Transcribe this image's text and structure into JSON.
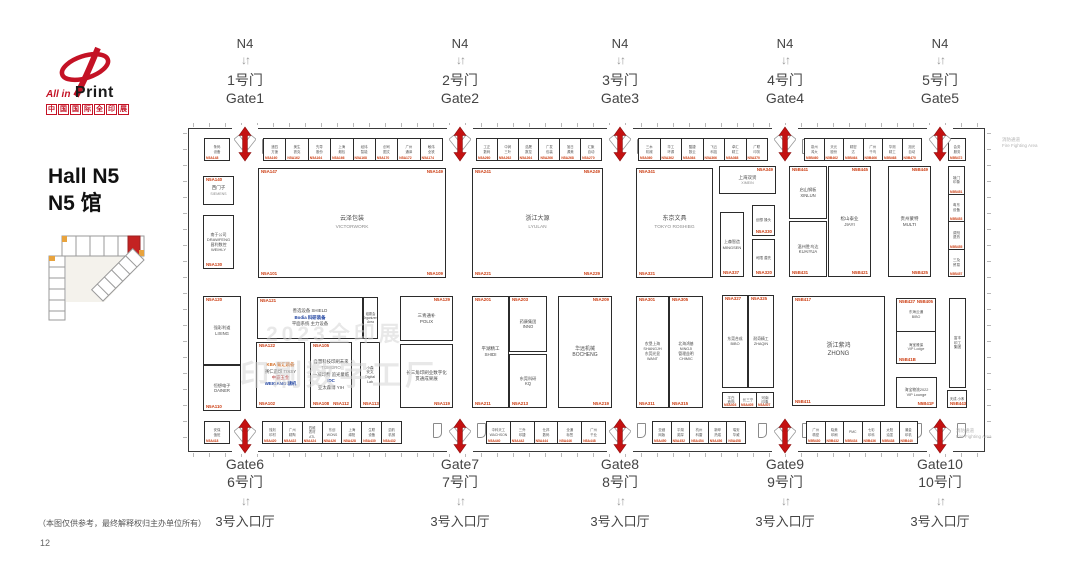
{
  "logo": {
    "line1": "All in",
    "line2": "Print",
    "line3": "中国国际全印展"
  },
  "hall": {
    "title_en": "Hall N5",
    "title_zh": "N5 馆"
  },
  "watermark": {
    "line1": "2023全印展",
    "line2": "印刷数字工厂"
  },
  "fire": {
    "zh": "消防通道",
    "en": "Fire Fighting Area"
  },
  "footer": {
    "disclaimer": "（本图仅供参考，最终解释权归主办单位所有）",
    "page": "12"
  },
  "shared": {
    "n4": "N4",
    "arrow_down_up": "↓↑",
    "entrance": "3号入口厅"
  },
  "top_gates": [
    {
      "zh": "1号门",
      "en": "Gate1",
      "x": 245
    },
    {
      "zh": "2号门",
      "en": "Gate2",
      "x": 460
    },
    {
      "zh": "3号门",
      "en": "Gate3",
      "x": 620
    },
    {
      "zh": "4号门",
      "en": "Gate4",
      "x": 785
    },
    {
      "zh": "5号门",
      "en": "Gate5",
      "x": 940
    }
  ],
  "bottom_gates": [
    {
      "en": "Gate6",
      "zh": "6号门",
      "x": 245
    },
    {
      "en": "Gate7",
      "zh": "7号门",
      "x": 460
    },
    {
      "en": "Gate8",
      "zh": "8号门",
      "x": 620
    },
    {
      "en": "Gate9",
      "zh": "9号门",
      "x": 785
    },
    {
      "en": "Gate10",
      "zh": "10号门",
      "x": 940
    }
  ],
  "plan": {
    "x": 188,
    "y": 128,
    "w": 797,
    "h": 324
  },
  "booths": [
    {
      "x": 203,
      "y": 176,
      "w": 31,
      "h": 29,
      "name": "西门子",
      "sub": "SIEMENS",
      "tl": "N5A140",
      "fs": 4.5
    },
    {
      "x": 203,
      "y": 215,
      "w": 31,
      "h": 54,
      "name": "南于公司\nDRAWFENG\n昌利数控\nWEIHLY",
      "bl": "N5A130",
      "fs": 4
    },
    {
      "x": 258,
      "y": 168,
      "w": 188,
      "h": 110,
      "name": "云泽包装",
      "sub": "VICTORWORK",
      "tl": "N5A147",
      "tr": "N5A149",
      "bl": "N5A101",
      "br": "N5A109",
      "fs": 6
    },
    {
      "x": 472,
      "y": 168,
      "w": 131,
      "h": 110,
      "name": "浙江大源",
      "sub": "LYULAN",
      "tl": "N5A241",
      "tr": "N5A249",
      "bl": "N5A221",
      "br": "N5A229",
      "fs": 6
    },
    {
      "x": 636,
      "y": 168,
      "w": 77,
      "h": 110,
      "name": "东京文具",
      "sub": "TOKYO ROSHIBG",
      "tl": "N5A341",
      "bl": "N5A321",
      "fs": 6
    },
    {
      "x": 719,
      "y": 166,
      "w": 57,
      "h": 28,
      "name": "上海双贤",
      "sub": "XIMEIN",
      "tr": "N5A349",
      "fs": 4.5
    },
    {
      "x": 720,
      "y": 212,
      "w": 24,
      "h": 65,
      "name": "上森智造\nMINGSEN",
      "bl": "N5A337",
      "fs": 4
    },
    {
      "x": 752,
      "y": 205,
      "w": 23,
      "h": 31,
      "name": "创想 操头",
      "br": "N5A330",
      "fs": 3.6
    },
    {
      "x": 752,
      "y": 239,
      "w": 23,
      "h": 38,
      "name": "司限 潜先",
      "br": "N5A320",
      "fs": 3.6
    },
    {
      "x": 789,
      "y": 166,
      "w": 38,
      "h": 53,
      "name": "启山钢板\nXINLUN",
      "tl": "N5B441",
      "fs": 4.2
    },
    {
      "x": 789,
      "y": 221,
      "w": 38,
      "h": 56,
      "name": "温州胜鸟达\nKUAIYUA",
      "bl": "N5B431",
      "fs": 4.2
    },
    {
      "x": 828,
      "y": 166,
      "w": 43,
      "h": 111,
      "name": "松山泰业\nJIAYI",
      "tr": "N5B445",
      "br": "N5B421",
      "fs": 4.5
    },
    {
      "x": 888,
      "y": 166,
      "w": 43,
      "h": 111,
      "name": "贵州蒙特\nMULTI",
      "tr": "N5B449",
      "br": "N5B425",
      "fs": 4.5
    },
    {
      "x": 948,
      "y": 166,
      "w": 17,
      "h": 111,
      "cells": [
        {
          "t": "境门\n印象",
          "c": "N5B451"
        },
        {
          "t": "粤东\n设备",
          "c": "N5B453"
        },
        {
          "t": "调剂\n退热",
          "c": "N5B455"
        },
        {
          "t": "三及\n贸易",
          "c": "N5B457"
        }
      ]
    },
    {
      "x": 203,
      "y": 296,
      "w": 38,
      "h": 69,
      "name": "强彩利道\nLIXING",
      "tl": "N5A120",
      "fs": 4.2
    },
    {
      "x": 203,
      "y": 365,
      "w": 38,
      "h": 46,
      "name": "恒想电子\nDAINER",
      "bl": "N5A110",
      "fs": 4.2
    },
    {
      "x": 257,
      "y": 297,
      "w": 106,
      "h": 42,
      "tl": "N5A121",
      "lines": [
        {
          "t": "善选设备 SHIELD",
          "c": "#4a4a4a"
        },
        {
          "t": "Bodia 科研装备",
          "c": "#1b3f9e",
          "b": 1
        },
        {
          "t": "平面系统 主力设备",
          "c": "#4a4a4a"
        }
      ]
    },
    {
      "x": 363,
      "y": 297,
      "w": 15,
      "h": 42,
      "name": "组委会\nOrganizers\nArea",
      "fs": 3.2
    },
    {
      "x": 256,
      "y": 342,
      "w": 49,
      "h": 66,
      "tl": "N5A122",
      "bl": "N5A102",
      "lines": [
        {
          "t": "KBA 新汇装备",
          "c": "#d2691e",
          "b": 1
        },
        {
          "t": "赛仁造印 TISSY",
          "c": "#4a4a4a"
        },
        {
          "t": "中霸五金",
          "c": "#b03030"
        },
        {
          "t": "WEIGANG 精机",
          "c": "#1b3f9e",
          "b": 1
        }
      ]
    },
    {
      "x": 310,
      "y": 342,
      "w": 42,
      "h": 66,
      "tl": "N5A105",
      "bl": "N5A108",
      "br": "N5A112",
      "lines": [
        {
          "t": "自慧科技印刷未来",
          "c": "#4a4a4a"
        },
        {
          "t": "TOMORO",
          "c": "#888888"
        },
        {
          "t": "一减印费 追光童临",
          "c": "#4a4a4a"
        },
        {
          "t": "IDC",
          "c": "#1b3f9e",
          "b": 1
        },
        {
          "t": "亚太森博 YIH",
          "c": "#4a4a4a"
        }
      ]
    },
    {
      "x": 360,
      "y": 342,
      "w": 20,
      "h": 66,
      "name": "小森\n安文\nDigital\nLab",
      "bl": "N5A113",
      "fs": 3.6
    },
    {
      "x": 400,
      "y": 296,
      "w": 53,
      "h": 45,
      "name": "三青通补\nPOLIX",
      "tr": "N5A129",
      "fs": 4.5
    },
    {
      "x": 400,
      "y": 344,
      "w": 53,
      "h": 64,
      "name": "长三角印刷业数字化\n贯通成果展",
      "br": "N5A119",
      "fs": 4.5
    },
    {
      "x": 472,
      "y": 296,
      "w": 37,
      "h": 112,
      "name": "平湖精工\nSHIDI",
      "tl": "N5A201",
      "bl": "N5A211",
      "fs": 4.5
    },
    {
      "x": 509,
      "y": 296,
      "w": 38,
      "h": 56,
      "name": "药康集团\nINNO",
      "tl": "N5A203",
      "fs": 4.2
    },
    {
      "x": 509,
      "y": 354,
      "w": 38,
      "h": 54,
      "name": "东莞科研\nKQ",
      "bl": "N5A213",
      "fs": 4.2
    },
    {
      "x": 558,
      "y": 296,
      "w": 54,
      "h": 112,
      "name": "华远机械\nBOCHENG",
      "tr": "N5A209",
      "br": "N5A219",
      "fs": 5
    },
    {
      "x": 636,
      "y": 296,
      "w": 33,
      "h": 112,
      "name": "农垦上海\nSHANGJH\n东莞光显\nWANT",
      "tl": "N5A301",
      "bl": "N5A311",
      "fs": 3.8
    },
    {
      "x": 669,
      "y": 296,
      "w": 34,
      "h": 112,
      "name": "北海鸿基\nNINGJI\n管理益明\nCHIMIC",
      "tl": "N5A305",
      "bl": "N5A315",
      "fs": 3.8
    },
    {
      "x": 722,
      "y": 295,
      "w": 26,
      "h": 93,
      "name": "东莞合成\nBIBO",
      "tl": "N5A327",
      "fs": 3.8
    },
    {
      "x": 748,
      "y": 295,
      "w": 26,
      "h": 93,
      "name": "耐奇精工\nZHAQIN",
      "tl": "N5A325",
      "fs": 3.8
    },
    {
      "x": 722,
      "y": 392,
      "w": 52,
      "h": 16,
      "horiz": 1,
      "cells": [
        {
          "t": "平白\n首饰",
          "c": "N5A403"
        },
        {
          "t": "长三宁",
          "c": "N5A405"
        },
        {
          "t": "河南\n印象",
          "c": "N5A407"
        }
      ]
    },
    {
      "x": 792,
      "y": 296,
      "w": 93,
      "h": 110,
      "name": "浙江紫鸿\nZHONG",
      "tl": "N5B417",
      "bl": "N5B411",
      "fs": 6
    },
    {
      "x": 896,
      "y": 298,
      "w": 40,
      "h": 66,
      "tl": "N5B427",
      "tr": "N5B405",
      "bl": "N5B41B",
      "cells": [
        {
          "t": "东海云通\nBIBO"
        },
        {
          "t": "海宝雅保\nVIP Lodge"
        }
      ]
    },
    {
      "x": 896,
      "y": 377,
      "w": 41,
      "h": 31,
      "name": "海宝物流2022\nVIP Lounge",
      "br": "N5B41F",
      "fs": 3.8
    },
    {
      "x": 949,
      "y": 298,
      "w": 17,
      "h": 90,
      "name": "富丰\n印工\n集团",
      "fs": 3.6
    },
    {
      "x": 947,
      "y": 390,
      "w": 20,
      "h": 18,
      "name": "天成 小禾",
      "bl": "N5B443",
      "fs": 3.4
    }
  ],
  "strips": {
    "top": {
      "y": 138,
      "h": 23,
      "segments": [
        {
          "x": 204,
          "w": 26,
          "labels": [
            "条码 设备"
          ],
          "codes": [
            "N5A148"
          ]
        },
        {
          "x": 263,
          "w": 180,
          "labels": [
            "递四 方速",
            "美生 铁克",
            "先导 股份",
            "上海 烟包",
            "经纬 智能",
            "创司 图文",
            "广州 通泽",
            "敏伟 全铁"
          ],
          "codes": [
            "N5A160",
            "N5A162",
            "N5A164",
            "N5A166",
            "N5A168",
            "N5A170",
            "N5A172",
            "N5A174"
          ]
        },
        {
          "x": 476,
          "w": 126,
          "labels": [
            "工正 数码",
            "中润 三叶",
            "浩晟 数控",
            "广发 包装",
            "旭日 源美",
            "汇聚 自动"
          ],
          "codes": [
            "N5A260",
            "N5A262",
            "N5A264",
            "N5A266",
            "N5A268",
            "N5A270"
          ]
        },
        {
          "x": 638,
          "w": 130,
          "labels": [
            "三木 机械",
            "华工 环源",
            "酷捷 数云",
            "飞云 科技",
            "卓汇 精工",
            "广联 印务"
          ],
          "codes": [
            "N5A360",
            "N5A362",
            "N5A364",
            "N5A366",
            "N5A368",
            "N5A370"
          ]
        },
        {
          "x": 804,
          "w": 118,
          "labels": [
            "泉州 鸿大",
            "天元 股份",
            "精密 达",
            "广州 千鸟",
            "华测 精工",
            "旭光 自动"
          ],
          "codes": [
            "N5B460",
            "N5B462",
            "N5B464",
            "N5B466",
            "N5B468",
            "N5B470"
          ]
        },
        {
          "x": 948,
          "w": 18,
          "labels": [
            "会务 服务"
          ],
          "codes": [
            "N5B472"
          ]
        }
      ]
    },
    "bottom": {
      "y": 421,
      "h": 23,
      "segments": [
        {
          "x": 204,
          "w": 26,
          "labels": [
            "安保 值班"
          ],
          "codes": [
            "N5A418"
          ]
        },
        {
          "x": 262,
          "w": 140,
          "labels": [
            "蚀刻 印材",
            "广州 精陶",
            "四维 表材 ATL",
            "东创 WONS",
            "上海 绵阳",
            "生联 设备",
            "劲豹 机械"
          ],
          "codes": [
            "N5A420",
            "N5A422",
            "N5A424",
            "N5A426",
            "N5A428",
            "N5A430",
            "N5A432"
          ]
        },
        {
          "x": 486,
          "w": 120,
          "labels": [
            "中科天工 WACHSON",
            "三乔 印捷",
            "仕邦 数码",
            "全通 标签",
            "广州 千业"
          ],
          "codes": [
            "N5A440",
            "N5A442",
            "N5A444",
            "N5A446",
            "N5A448"
          ]
        },
        {
          "x": 652,
          "w": 94,
          "labels": [
            "亚细 网版",
            "平湖 英厚",
            "杭州 科雷",
            "新晔 热熔",
            "瑞安 华威"
          ],
          "codes": [
            "N5A450",
            "N5A452",
            "N5A454",
            "N5A456",
            "N5A458"
          ]
        },
        {
          "x": 806,
          "w": 112,
          "labels": [
            "广州 精密",
            "晓美 印刷",
            "PMC",
            "七彩 印科",
            "太阳 油墨",
            "潮金 印机"
          ],
          "codes": [
            "N5B430",
            "N5B432",
            "N5B434",
            "N5B436",
            "N5B438",
            "N5B440"
          ]
        }
      ]
    }
  }
}
